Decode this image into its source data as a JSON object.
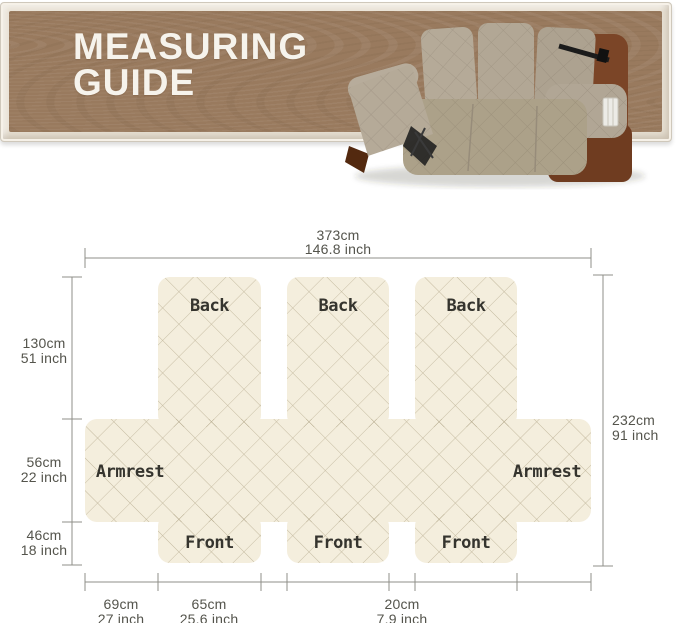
{
  "banner": {
    "title_line1": "MEASURING",
    "title_line2": "GUIDE",
    "background_color": "#997a5e",
    "frame_color": "#e9e2d5",
    "title_color": "#f6f3ec"
  },
  "hero": {
    "sofa_alt": "3-seat recliner sofa with beige quilted slipcover, left footrest reclined"
  },
  "diagram": {
    "fabric_color": "#f4eedd",
    "lattice_color": "#a49878",
    "line_color": "#8f8f88",
    "text_color": "#54544c",
    "labels": {
      "back": "Back",
      "front": "Front",
      "armrest": "Armrest"
    },
    "measurements": {
      "total_width": {
        "cm": "373cm",
        "inch": "146.8 inch"
      },
      "back_height": {
        "cm": "130cm",
        "inch": "51 inch"
      },
      "armrest_height": {
        "cm": "56cm",
        "inch": "22 inch"
      },
      "front_height": {
        "cm": "46cm",
        "inch": "18 inch"
      },
      "total_height": {
        "cm": "232cm",
        "inch": "91 inch"
      },
      "armrest_width": {
        "cm": "69cm",
        "inch": "27 inch"
      },
      "seat_width": {
        "cm": "65cm",
        "inch": "25.6 inch"
      },
      "gap_width": {
        "cm": "20cm",
        "inch": "7.9 inch"
      }
    }
  }
}
